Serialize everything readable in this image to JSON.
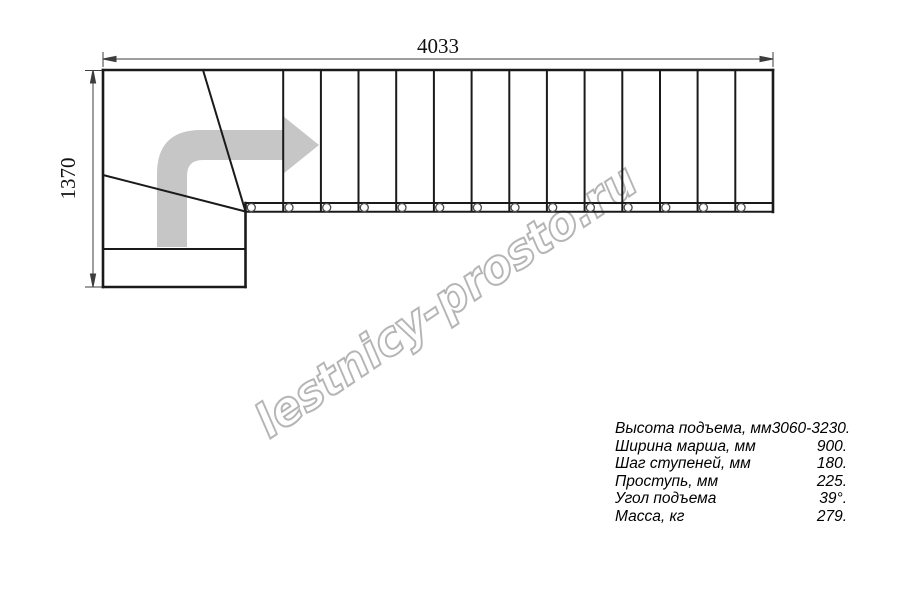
{
  "diagram": {
    "type": "staircase-plan-drawing",
    "watermark_text": "lestnicy-prosto.ru",
    "dimensions": {
      "total_length": "4033",
      "total_width": "1370"
    },
    "straight_run": {
      "tread_count": 14,
      "baluster_count": 14
    },
    "colors": {
      "line": "#1a1a1a",
      "dim_line": "#3d3d3d",
      "arrow": "#c6c6c6",
      "watermark": "#b5b5b5"
    }
  },
  "specs": {
    "rows": [
      {
        "label": "Высота подъема, мм",
        "value": "3060-3230."
      },
      {
        "label": "Ширина марша, мм",
        "value": "900."
      },
      {
        "label": "Шаг ступеней, мм",
        "value": "180."
      },
      {
        "label": "Проступь, мм",
        "value": "225."
      },
      {
        "label": "Угол подъема",
        "value": "39°."
      },
      {
        "label": "Масса, кг",
        "value": "279."
      }
    ]
  }
}
